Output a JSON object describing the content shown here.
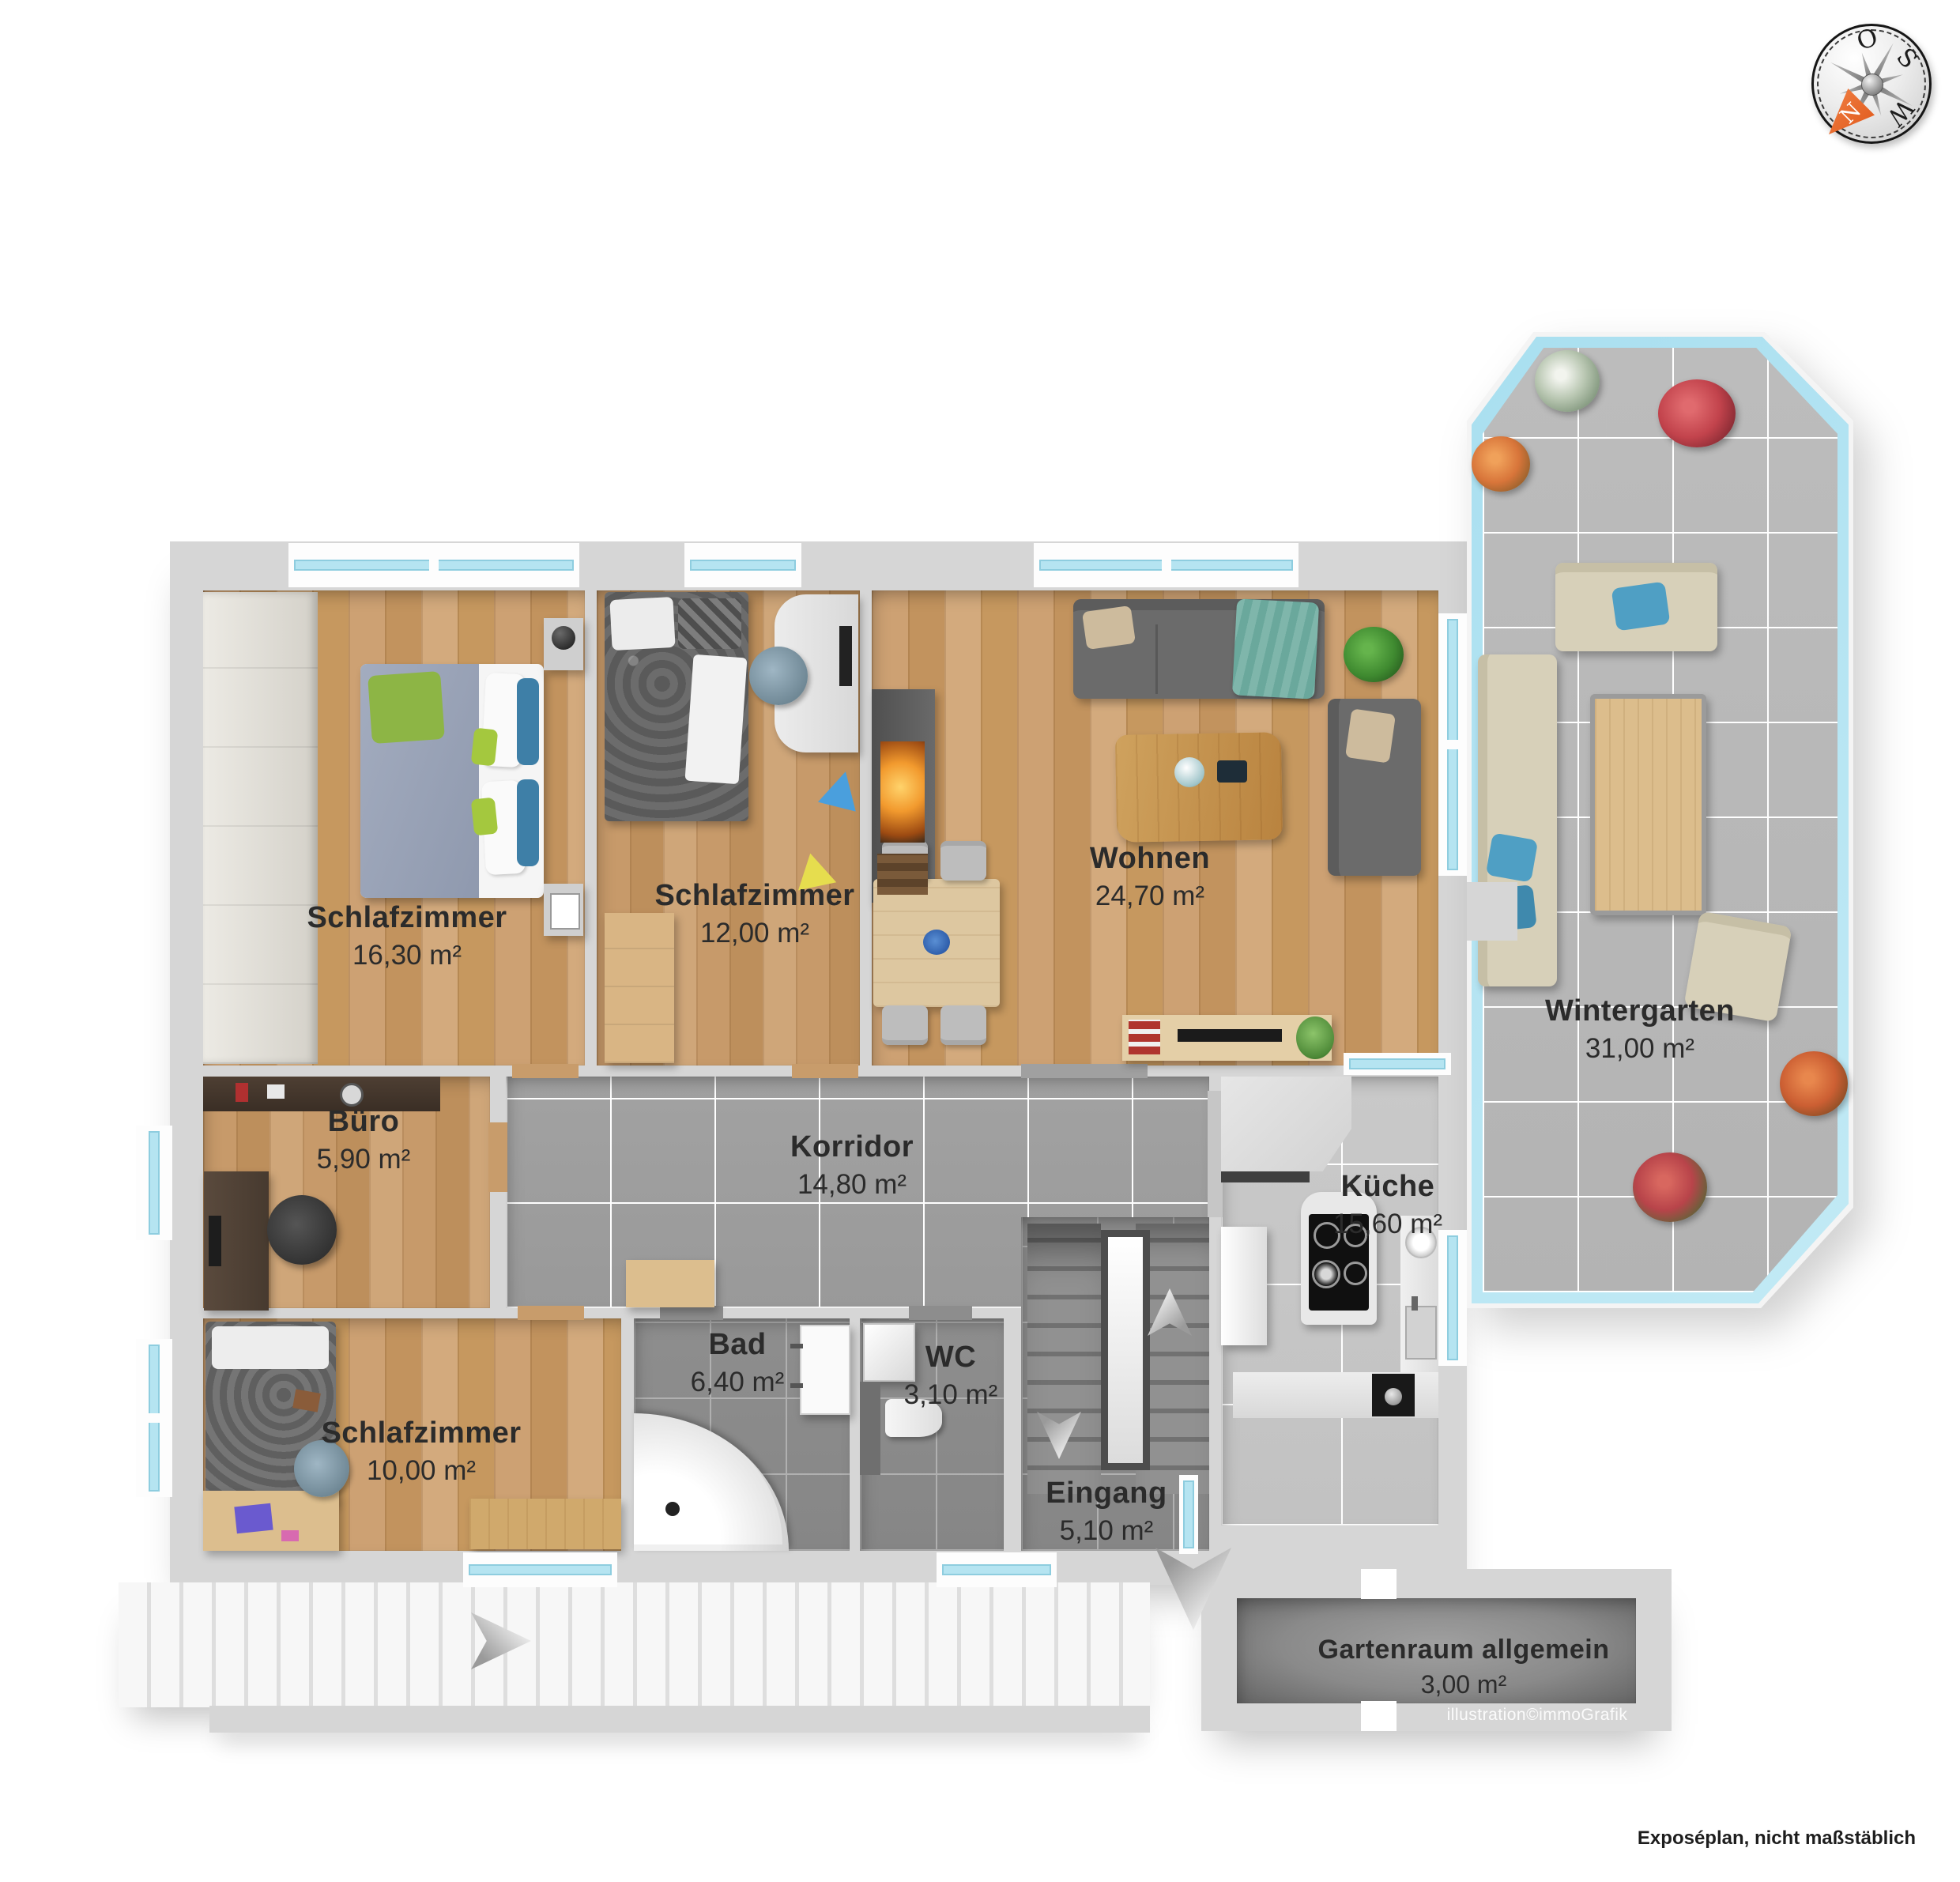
{
  "meta": {
    "footer": "Exposéplan, nicht maßstäblich",
    "credit": "illustration©immoGrafik"
  },
  "compass": {
    "n": "N",
    "o": "O",
    "s": "S",
    "w": "W",
    "arrow_color": "#e0581a"
  },
  "rooms": {
    "schlafzimmer1": {
      "name": "Schlafzimmer",
      "area": "16,30 m²"
    },
    "schlafzimmer2": {
      "name": "Schlafzimmer",
      "area": "12,00 m²"
    },
    "wohnen": {
      "name": "Wohnen",
      "area": "24,70 m²"
    },
    "buero": {
      "name": "Büro",
      "area": "5,90 m²"
    },
    "korridor": {
      "name": "Korridor",
      "area": "14,80 m²"
    },
    "kueche": {
      "name": "Küche",
      "area": "15,60 m²"
    },
    "schlafzimmer3": {
      "name": "Schlafzimmer",
      "area": "10,00 m²"
    },
    "bad": {
      "name": "Bad",
      "area": "6,40 m²"
    },
    "wc": {
      "name": "WC",
      "area": "3,10 m²"
    },
    "eingang": {
      "name": "Eingang",
      "area": "5,10 m²"
    },
    "wintergarten": {
      "name": "Wintergarten",
      "area": "31,00 m²"
    },
    "gartenraum": {
      "name": "Gartenraum allgemein",
      "area": "3,00 m²"
    }
  },
  "colors": {
    "wall": "#d6d6d6",
    "wood_floor": "#c89c6b",
    "corridor_tile": "#9d9d9d",
    "bath_tile": "#8a8a8a",
    "kitchen_tile": "#c6c6c6",
    "wintergarten_tile": "#b7b7b7",
    "window_glass": "#b5e4f1",
    "label_text": "#2b2b2b",
    "compass_arrow": "#e0581a"
  }
}
